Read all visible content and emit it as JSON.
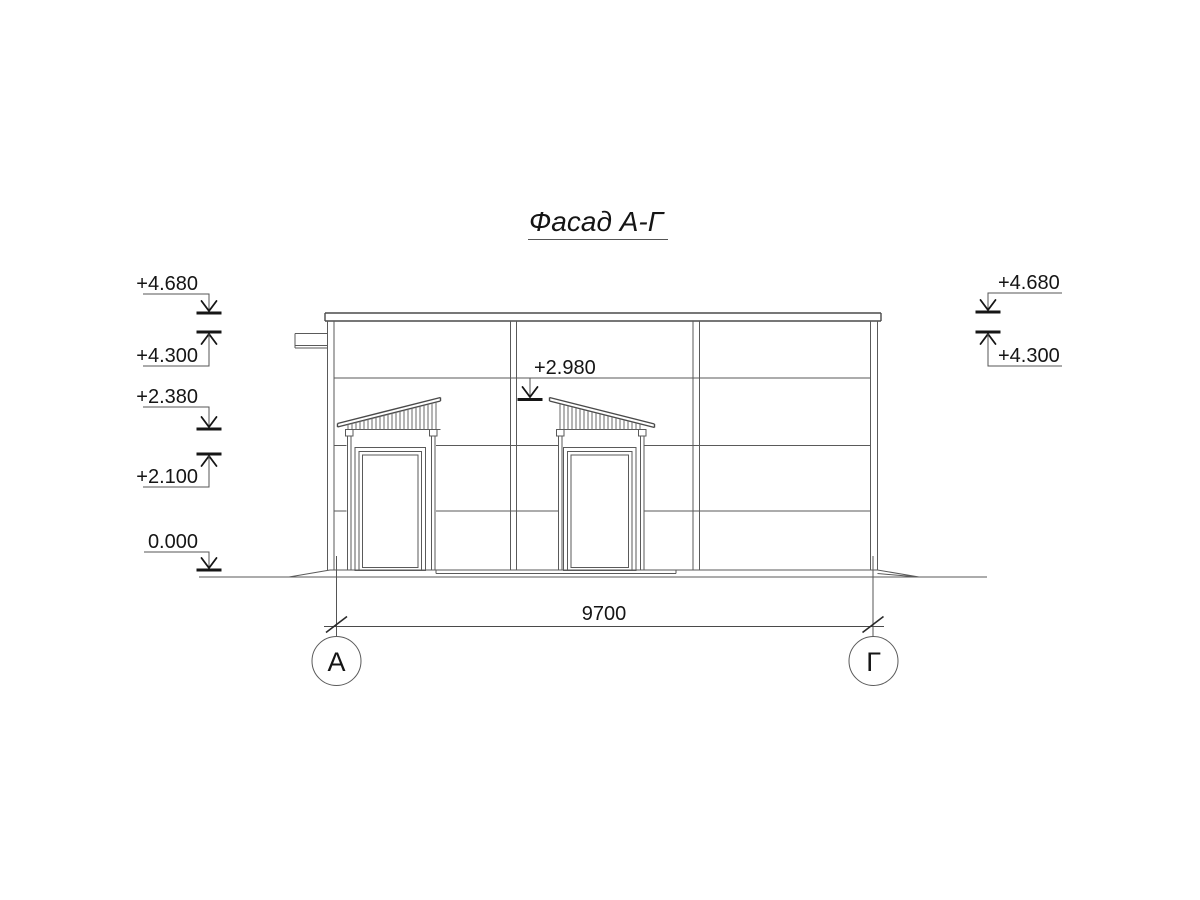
{
  "title": {
    "text": "Фасад А-Г"
  },
  "elevation_markers": {
    "left": [
      {
        "label": "+4.680",
        "direction": "down"
      },
      {
        "label": "+4.300",
        "direction": "up"
      },
      {
        "label": "+2.380",
        "direction": "down"
      },
      {
        "label": "+2.100",
        "direction": "up"
      },
      {
        "label": "0.000",
        "direction": "down"
      }
    ],
    "right": [
      {
        "label": "+4.680",
        "direction": "down"
      },
      {
        "label": "+4.300",
        "direction": "up"
      }
    ],
    "middle": [
      {
        "label": "+2.980",
        "direction": "down"
      }
    ]
  },
  "dimension": {
    "label": "9700"
  },
  "axes": {
    "left": "А",
    "right": "Г"
  },
  "colors": {
    "background": "#ffffff",
    "line": "#5a5a5a",
    "annotation": "#161616"
  }
}
